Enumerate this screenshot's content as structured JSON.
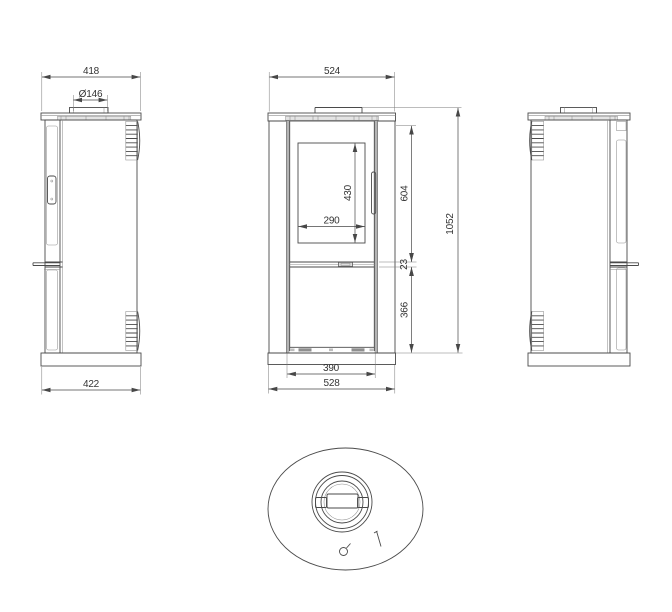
{
  "drawing": {
    "type": "stove-technical-drawing",
    "views": [
      "left-side-view",
      "front-view",
      "right-side-view",
      "top-view"
    ]
  },
  "dims": {
    "side_top_width": "418",
    "flue_diameter": "Ø146",
    "side_base_width": "422",
    "front_top_width": "524",
    "glass_width": "290",
    "glass_height": "430",
    "upper_body_height": "604",
    "shelf_gap": "23",
    "lower_body_height": "366",
    "total_height": "1052",
    "firebox_width": "390",
    "front_base_width": "528"
  },
  "colors": {
    "background": "#ffffff",
    "line": "#4a4a4a",
    "light_line": "#8f8f8f",
    "dimension": "#333333",
    "shading": "#b4b4b4"
  }
}
